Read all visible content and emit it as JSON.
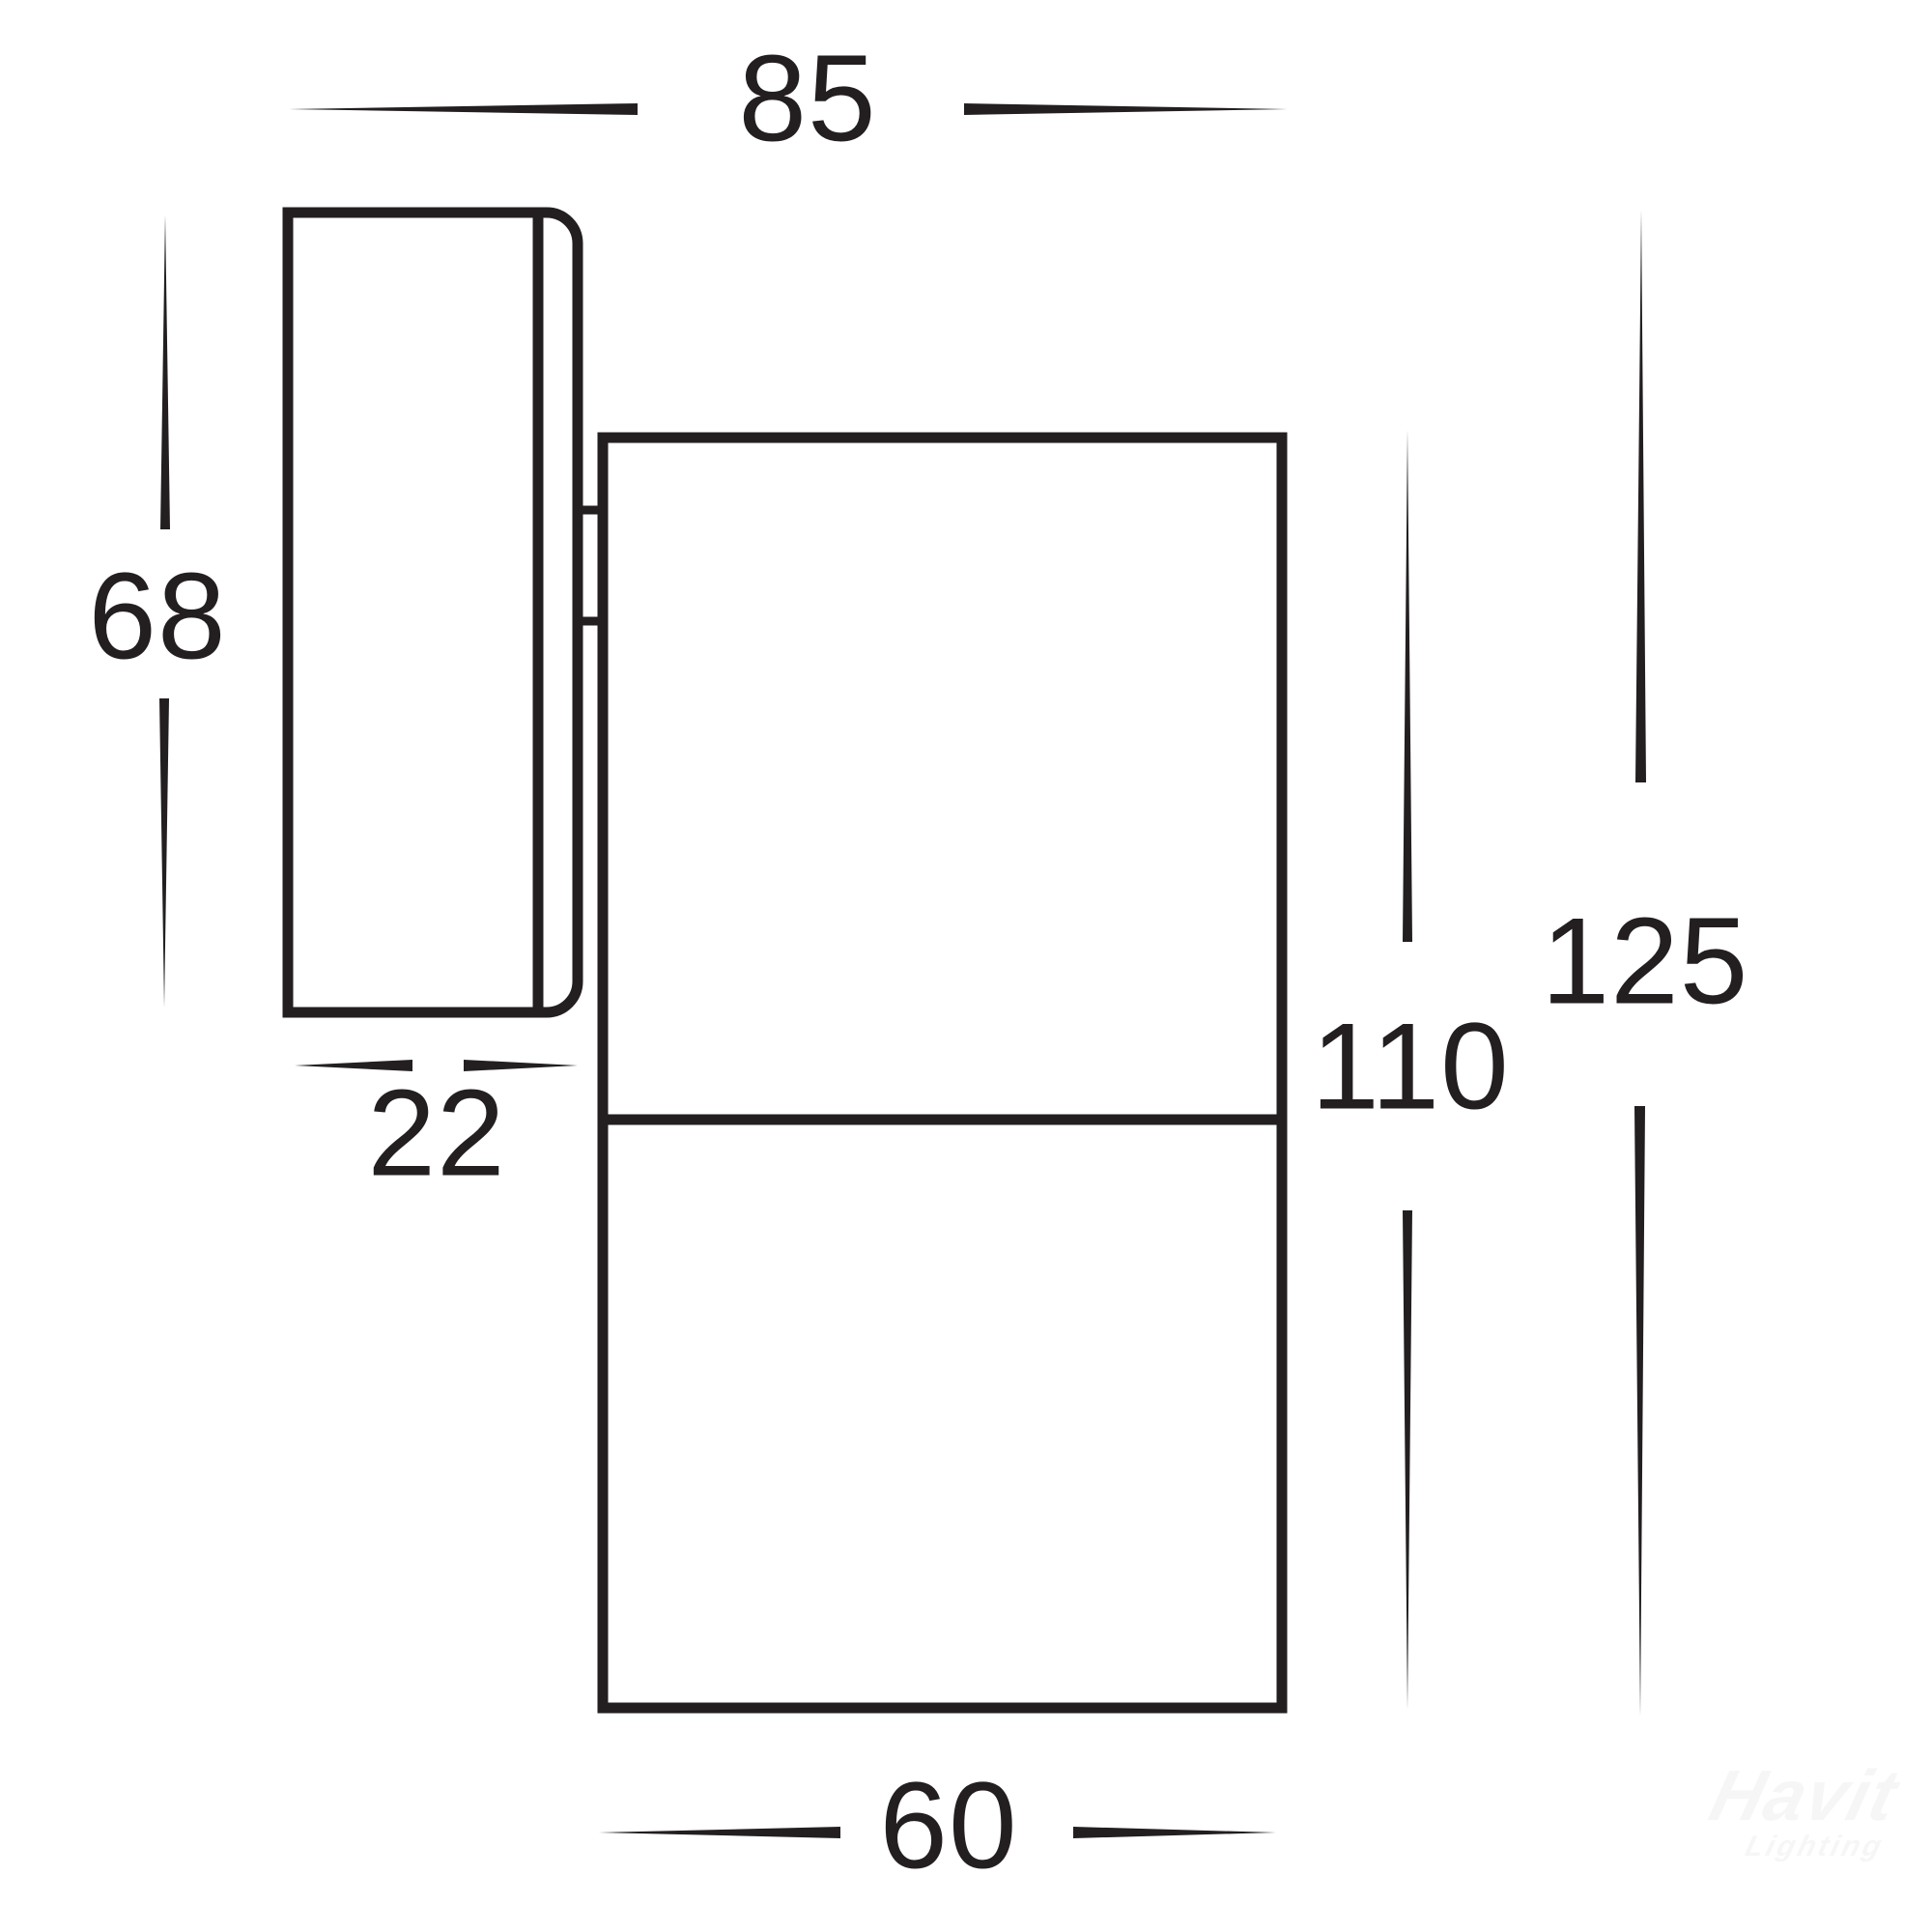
{
  "diagram": {
    "type": "technical dimension drawing of wall-mounted spotlight fixture (side view)",
    "units": "mm",
    "colors": {
      "line": "#231f20",
      "background": "#ffffff",
      "watermark": "#f6f6f7"
    },
    "dimensions": {
      "top_width": "85",
      "plate_height": "68",
      "plate_depth": "22",
      "body_height": "110",
      "total_height": "125",
      "body_width": "60"
    },
    "watermark": {
      "brand": "Havit",
      "sub": "Lighting"
    }
  }
}
